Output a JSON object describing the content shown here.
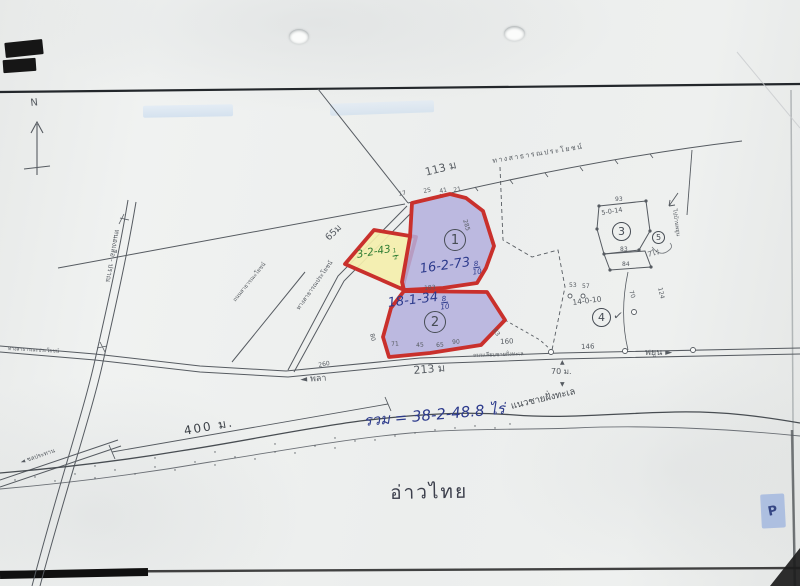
{
  "colors": {
    "plot_fill_blue": "#b4afdd",
    "plot_fill_yellow": "#f4efad",
    "plot_border_red": "#c9302c",
    "ink_blue": "#2c3a8c",
    "ink_green": "#2f7d33",
    "pencil": "#565b61",
    "sticker_blue": "#a8bbe0"
  },
  "icons": {
    "arrow_left": "◄",
    "arrow_right": "►",
    "arrow_up": "▲",
    "arrow_down": "▼",
    "check_mark": "✓"
  },
  "compass": {
    "label": "N"
  },
  "roads": {
    "top_public_road": "ทางสาธารณประโยชน์",
    "top_distance": "113 ม",
    "diag_public_road": "ทางสาธารณประโยชน์",
    "diag_distance": "65ม",
    "small_road": "ถนนสาธารณะโยชน์",
    "vertical_road": "หนองเสือ - ปราณ",
    "left_public_road": "ทางสาธารณะประโยชน์",
    "coastal_road": "ถนนเลียบชายฝั่งทะเล",
    "dest_west": "พลา",
    "dest_east": "พยูน",
    "canal_road": "ชลประทาน",
    "dim_400": "400 ม.",
    "dist_213": "213 ม",
    "dist_260": "260",
    "beach_gap": "70 ม.",
    "seg_160": "160",
    "seg_146": "146"
  },
  "plots": {
    "yellow": {
      "area": "3-2-43",
      "frac_num": "1",
      "frac_den": "2"
    },
    "plot1": {
      "number": "1",
      "area": "16-2-73",
      "frac_num": "8",
      "frac_den": "10"
    },
    "plot2": {
      "number": "2",
      "area": "18-1-34",
      "frac_num": "8",
      "frac_den": "10"
    },
    "plot3": {
      "number": "3",
      "area": "5-0-14"
    },
    "plot4": {
      "number": "4",
      "area": "14-0-10"
    },
    "plot5": {
      "number": "5",
      "note": "7ไร่",
      "direction": "ไปบ้านพยูน"
    }
  },
  "edge_numbers": {
    "n17": "17",
    "n25": "25",
    "n41": "41",
    "n21": "21",
    "n285": "285",
    "n183": "183",
    "n80": "80",
    "n71": "71",
    "n45": "45",
    "n65": "65",
    "n90": "90",
    "n63": "63",
    "n93": "93",
    "n83": "83",
    "n84": "84",
    "n53": "53",
    "n57": "57",
    "n124": "124",
    "n70": "70"
  },
  "summary": {
    "total": "รวม = 38-2-48.8 ไร่",
    "coastline_label": "แนวชายฝั่งทะเล",
    "sea_name": "อ่าวไทย"
  },
  "sticker": {
    "label": "P"
  }
}
